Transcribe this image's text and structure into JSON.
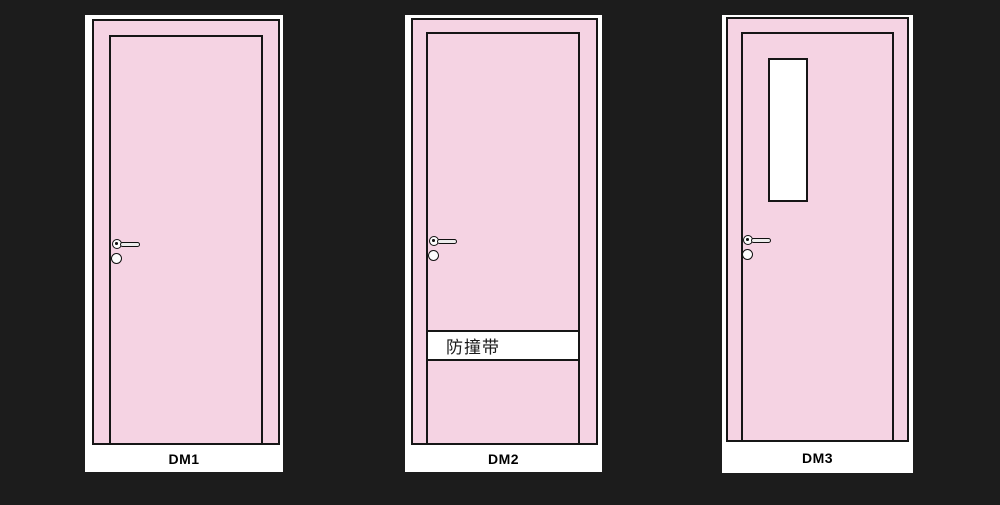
{
  "colors": {
    "background": "#1c1c1c",
    "door_pink": "#f5d3e3",
    "panel_white": "#ffffff",
    "outline_black": "#161616"
  },
  "doors": [
    {
      "label": "DM1",
      "feature": "plain"
    },
    {
      "label": "DM2",
      "feature": "crash-rail",
      "crash_rail_text": "防撞带"
    },
    {
      "label": "DM3",
      "feature": "vision-panel"
    }
  ]
}
